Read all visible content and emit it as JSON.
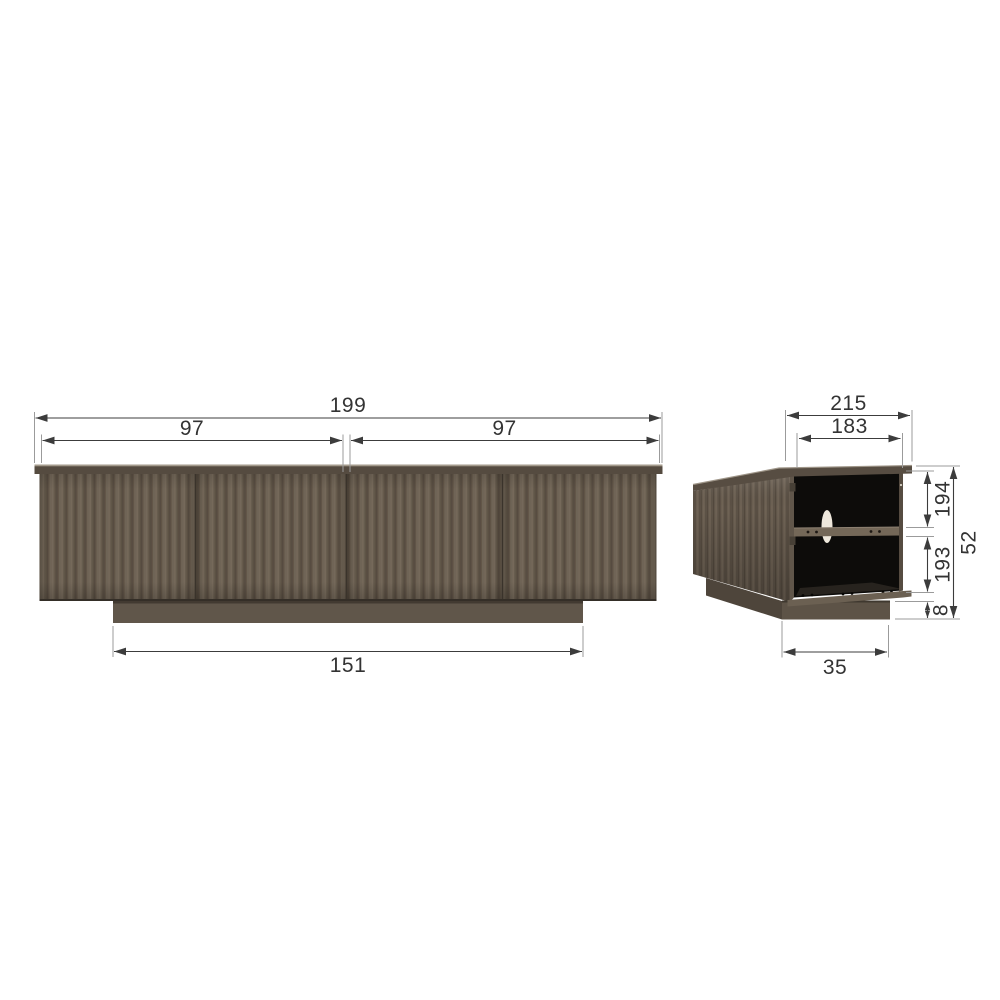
{
  "diagram": {
    "type": "furniture-dimension-drawing",
    "subject": "tv-cabinet-with-fluted-doors",
    "views": {
      "front": {
        "label": "front view",
        "dimensions": {
          "total_width": "199",
          "left_doors_width": "97",
          "right_doors_width": "97",
          "plinth_width": "151"
        }
      },
      "side": {
        "label": "side view (open back)",
        "dimensions": {
          "total_depth": "215",
          "inner_depth": "183",
          "upper_compartment_height": "194",
          "lower_compartment_height": "193",
          "plinth_height": "8",
          "total_height": "52",
          "plinth_depth": "35"
        }
      }
    },
    "colors": {
      "body_wood": "#6b6052",
      "wood_dark_stripe": "#564b40",
      "top_board": "#574d42",
      "plinth": "#5d5347",
      "interior": "#0d0c0a",
      "dimension_line": "#3c3c3c",
      "extension_line": "#9b9b9b",
      "label_text": "#333333",
      "background": "#ffffff"
    }
  }
}
